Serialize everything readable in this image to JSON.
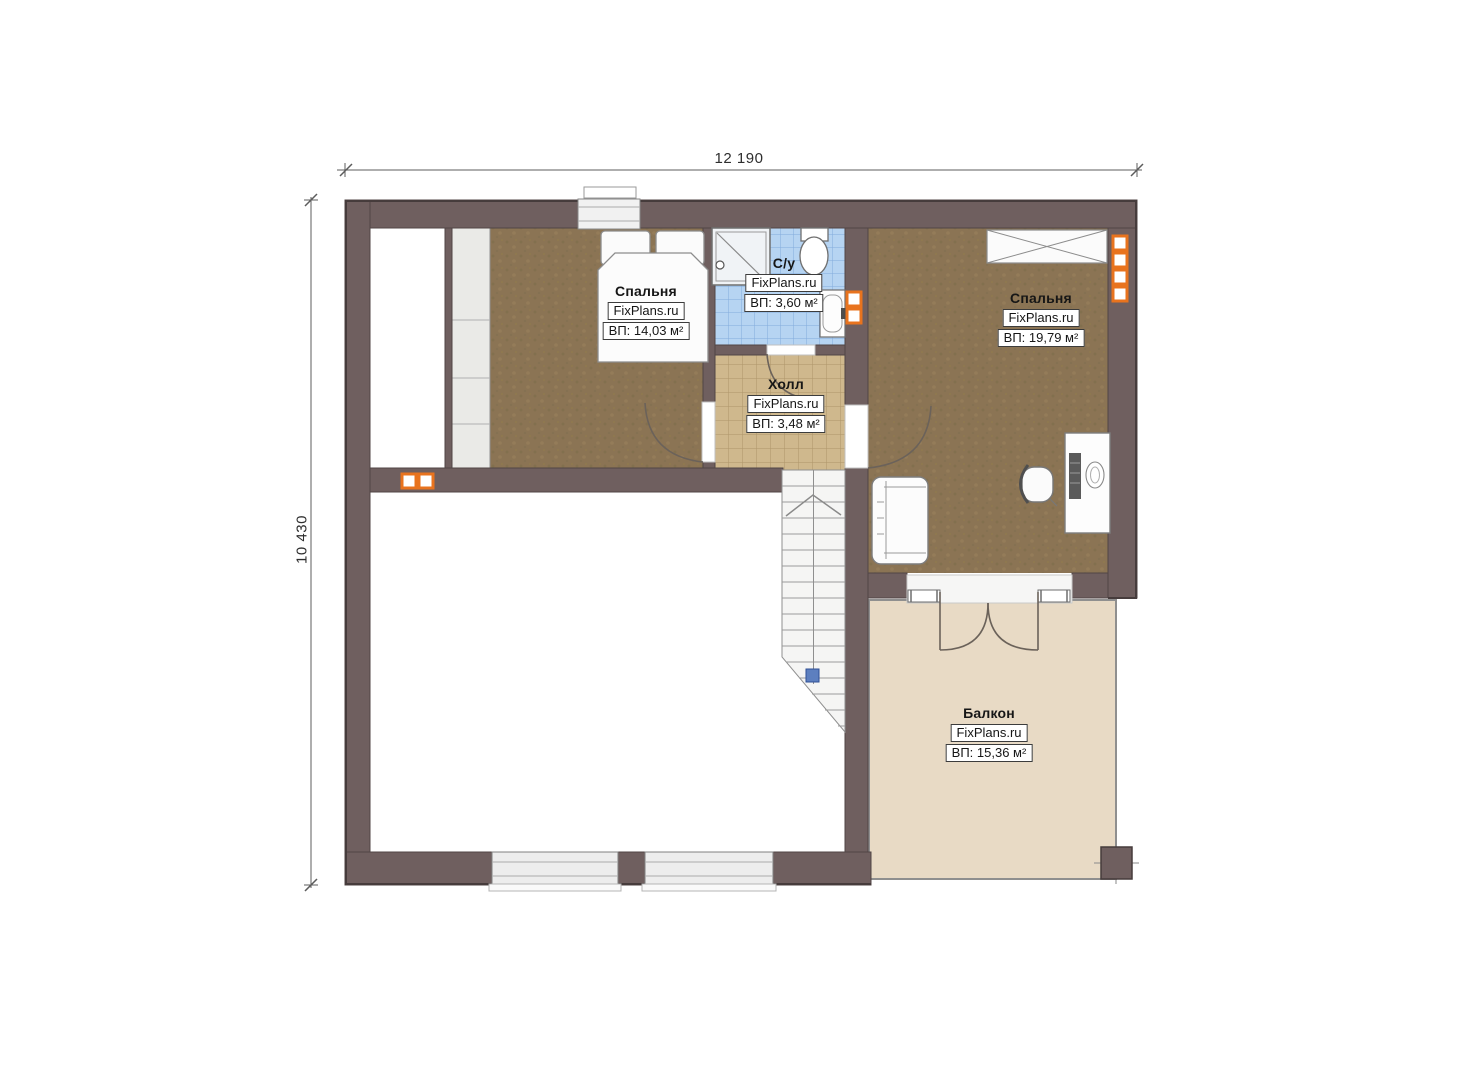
{
  "plan": {
    "type": "floor-plan",
    "dimensions": {
      "width_label": "12 190",
      "height_label": "10 430"
    },
    "rooms": [
      {
        "id": "bedroom-left",
        "name": "Спальня",
        "watermark": "FixPlans.ru",
        "area": "ВП: 14,03 м²"
      },
      {
        "id": "bathroom",
        "name": "С/у",
        "watermark": "FixPlans.ru",
        "area": "ВП: 3,60 м²"
      },
      {
        "id": "hall",
        "name": "Холл",
        "watermark": "FixPlans.ru",
        "area": "ВП: 3,48 м²"
      },
      {
        "id": "bedroom-right",
        "name": "Спальня",
        "watermark": "FixPlans.ru",
        "area": "ВП: 19,79 м²"
      },
      {
        "id": "balcony",
        "name": "Балкон",
        "watermark": "FixPlans.ru",
        "area": "ВП: 15,36 м²"
      }
    ],
    "colors": {
      "wall": "#6f5f5f",
      "wood_floor": "#8b7454",
      "hall_tile": "#cfb88d",
      "bath_tile": "#b6d4f2",
      "balcony_floor": "#e8dac5",
      "radiator_accent": "#e8731e",
      "stair_marker_blue": "#5d7fbf",
      "background": "#ffffff"
    }
  }
}
